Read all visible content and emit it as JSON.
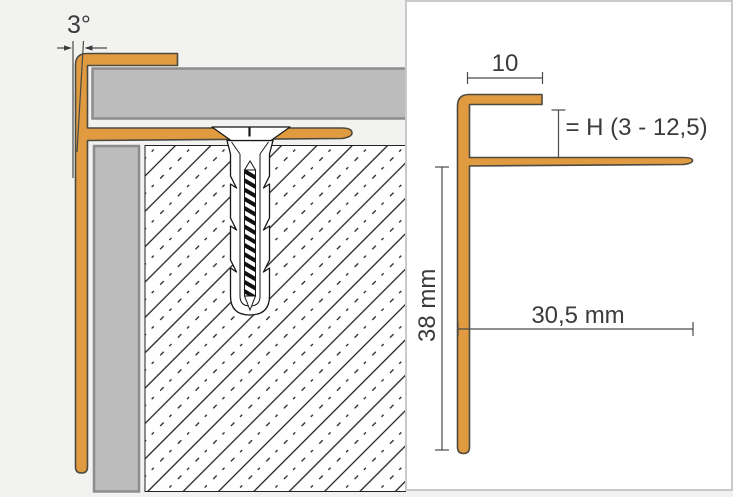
{
  "left_diagram": {
    "angle_label": "3°"
  },
  "right_diagram": {
    "top_width_label": "10",
    "height_label": "= H (3 - 12,5)",
    "leg_length_label": "38 mm",
    "flange_length_label": "30,5 mm"
  },
  "colors": {
    "profile_orange": "#E09A3F",
    "profile_outline": "#4C4A40",
    "tile_fill": "#BCBCBC",
    "tile_border": "#8C8C8C",
    "background": "#F2F2F1",
    "panel_background": "#FFFFFF",
    "panel_border": "#C9C9C9",
    "dimension_color": "#3B3B3B",
    "hatch_line_color": "#1A1A1A"
  }
}
